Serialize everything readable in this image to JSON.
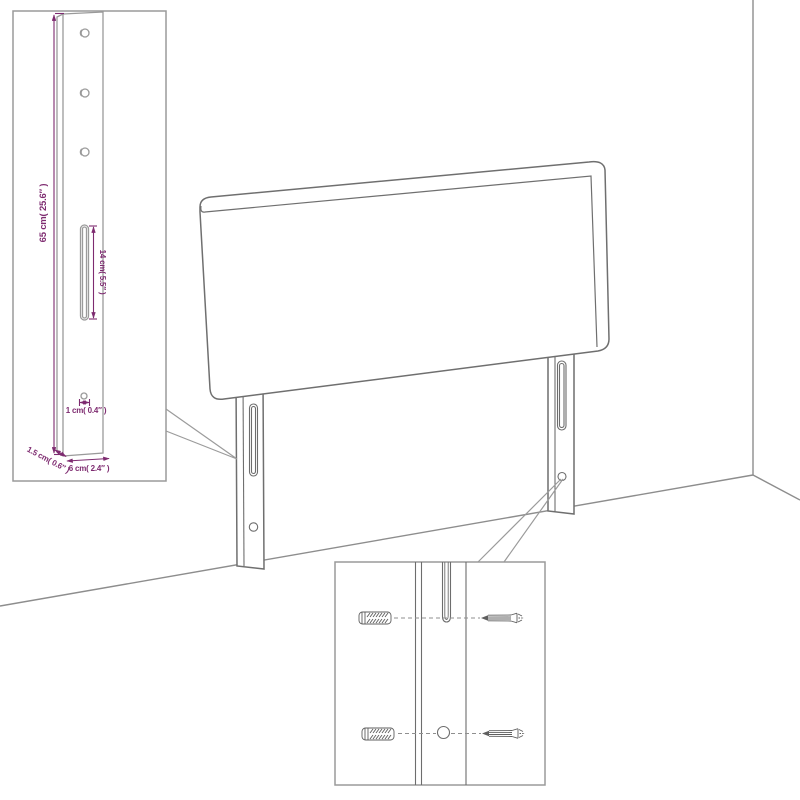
{
  "diagram": {
    "kind": "furniture-assembly-line-drawing",
    "subject_labels": {
      "main_view": "headboard-against-wall-corner",
      "inset_top_left": "mounting-leg-dimension-view",
      "inset_bottom": "wall-anchor-and-screw-detail-view"
    }
  },
  "colors": {
    "background": "#ffffff",
    "outline": "#6f6f6f",
    "wall_line": "#8d8d8d",
    "inset_line": "#9a9a9a",
    "dimension": "#7e2b70"
  },
  "dimension_inset": {
    "height_label": "65 cm( 25.6″ )",
    "slot_label": "14 cm( 5.5″ )",
    "hole_label": "1 cm( 0.4″ )",
    "depth_label": "1.5 cm( 0.6″ )",
    "width_label": "6 cm( 2.4″ )"
  }
}
